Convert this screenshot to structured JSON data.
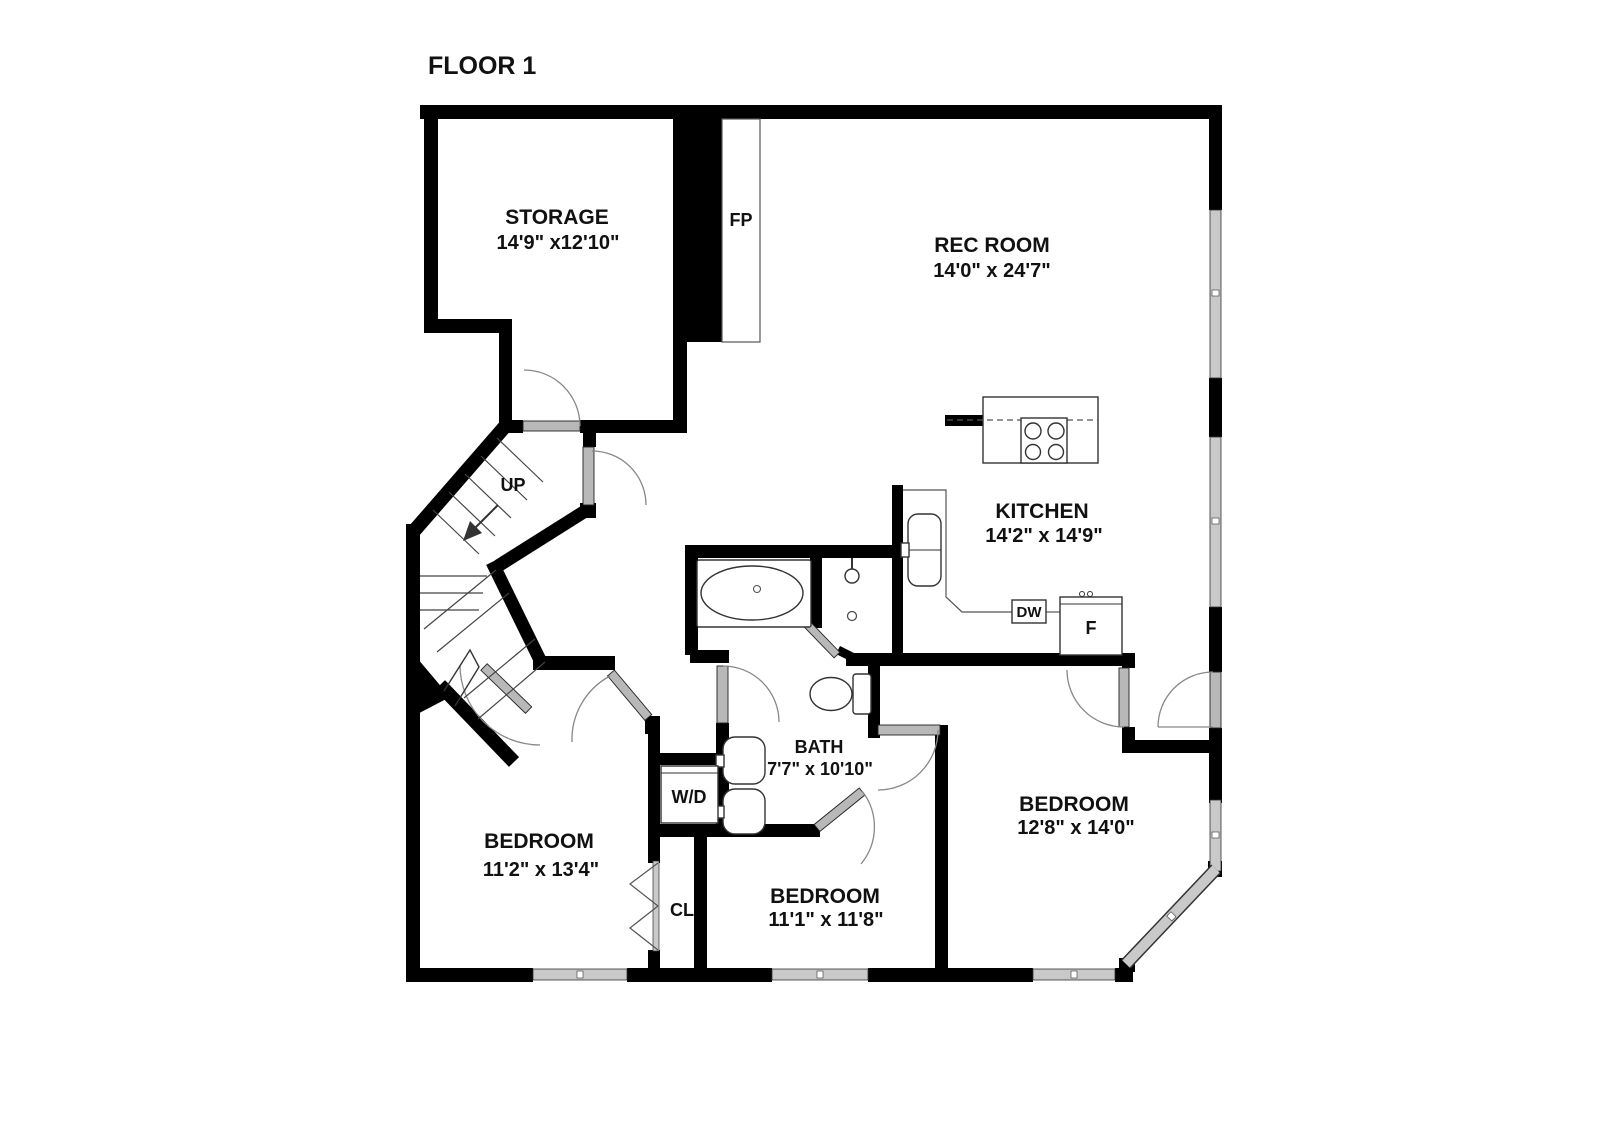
{
  "title": "FLOOR 1",
  "rooms": {
    "storage": {
      "name": "STORAGE",
      "dims": "14'9\" x12'10\""
    },
    "rec_room": {
      "name": "REC ROOM",
      "dims": "14'0\" x 24'7\""
    },
    "kitchen": {
      "name": "KITCHEN",
      "dims": "14'2\" x 14'9\""
    },
    "bath": {
      "name": "BATH",
      "dims": "7'7\" x 10'10\""
    },
    "bedroom_left": {
      "name": "BEDROOM",
      "dims": "11'2\" x 13'4\""
    },
    "bedroom_middle": {
      "name": "BEDROOM",
      "dims": "11'1\" x 11'8\""
    },
    "bedroom_right": {
      "name": "BEDROOM",
      "dims": "12'8\" x 14'0\""
    }
  },
  "labels": {
    "fireplace": "FP",
    "stairs_up": "UP",
    "dishwasher": "DW",
    "fridge": "F",
    "washer_dryer": "W/D",
    "closet": "CL"
  },
  "colors": {
    "wall": "#000000",
    "window": "#c9c9c9",
    "background": "#ffffff",
    "text": "#111111"
  }
}
